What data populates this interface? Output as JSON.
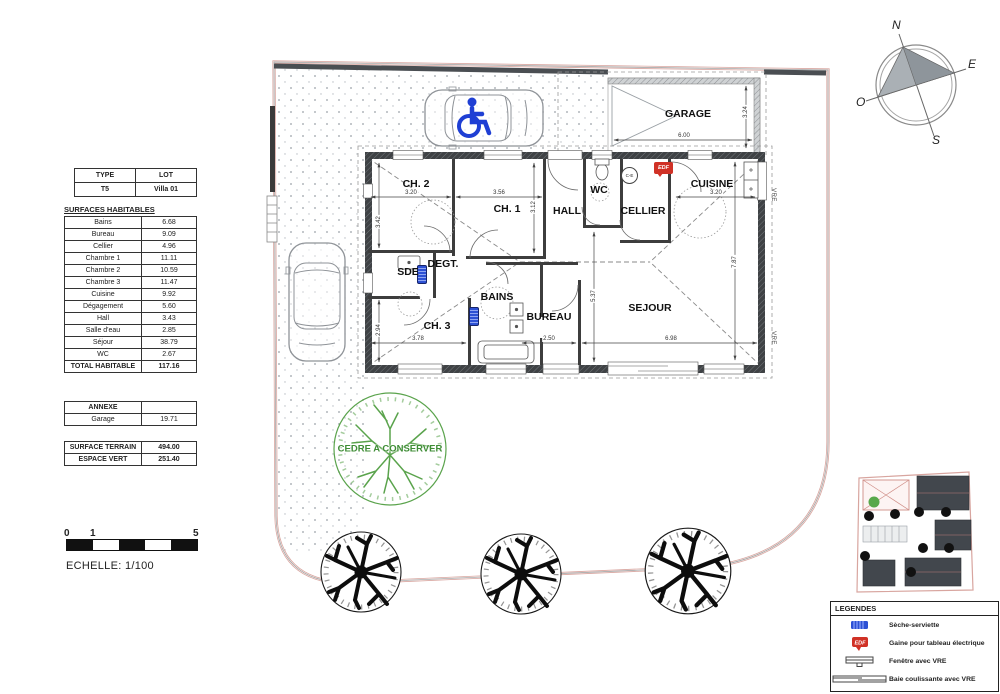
{
  "type_table": {
    "headers": [
      "TYPE",
      "LOT"
    ],
    "row": [
      "T5",
      "Villa 01"
    ]
  },
  "surfaces": {
    "title": "SURFACES HABITABLES",
    "rows": [
      [
        "Bains",
        "6.68"
      ],
      [
        "Bureau",
        "9.09"
      ],
      [
        "Cellier",
        "4.96"
      ],
      [
        "Chambre 1",
        "11.11"
      ],
      [
        "Chambre 2",
        "10.59"
      ],
      [
        "Chambre 3",
        "11.47"
      ],
      [
        "Cuisine",
        "9.92"
      ],
      [
        "Dégagement",
        "5.60"
      ],
      [
        "Hall",
        "3.43"
      ],
      [
        "Salle d'eau",
        "2.85"
      ],
      [
        "Séjour",
        "38.79"
      ],
      [
        "WC",
        "2.67"
      ]
    ],
    "total_label": "TOTAL HABITABLE",
    "total_value": "117.16"
  },
  "annexe": {
    "header": "ANNEXE",
    "rows": [
      [
        "Garage",
        "19.71"
      ]
    ]
  },
  "terrain": {
    "rows": [
      [
        "SURFACE TERRAIN",
        "494.00"
      ],
      [
        "ESPACE VERT",
        "251.40"
      ]
    ]
  },
  "scale": {
    "ticks": [
      "0",
      "1",
      "5"
    ],
    "caption": "ECHELLE: 1/100"
  },
  "compass": {
    "n": "N",
    "e": "E",
    "s": "S",
    "o": "O"
  },
  "plan": {
    "rooms": [
      {
        "name": "GARAGE",
        "x": 688,
        "y": 114
      },
      {
        "name": "CH. 2",
        "x": 416,
        "y": 184
      },
      {
        "name": "CH. 1",
        "x": 507,
        "y": 209
      },
      {
        "name": "HALL",
        "x": 567,
        "y": 211
      },
      {
        "name": "WC",
        "x": 599,
        "y": 190
      },
      {
        "name": "CELLIER",
        "x": 643,
        "y": 211
      },
      {
        "name": "CUISINE",
        "x": 712,
        "y": 184
      },
      {
        "name": "SDE",
        "x": 408,
        "y": 272
      },
      {
        "name": "DEGT.",
        "x": 443,
        "y": 264
      },
      {
        "name": "BAINS",
        "x": 497,
        "y": 297
      },
      {
        "name": "CH. 3",
        "x": 437,
        "y": 326
      },
      {
        "name": "BUREAU",
        "x": 549,
        "y": 317
      },
      {
        "name": "SEJOUR",
        "x": 650,
        "y": 308
      }
    ],
    "dimensions": [
      {
        "label": "3.20",
        "x": 411,
        "y": 193
      },
      {
        "label": "3.56",
        "x": 499,
        "y": 193
      },
      {
        "label": "3.42",
        "x": 379,
        "y": 222,
        "v": true
      },
      {
        "label": "3.12",
        "x": 534,
        "y": 207,
        "v": true
      },
      {
        "label": "3.78",
        "x": 418,
        "y": 339
      },
      {
        "label": "2.94",
        "x": 379,
        "y": 330,
        "v": true
      },
      {
        "label": "2.50",
        "x": 549,
        "y": 339
      },
      {
        "label": "6.98",
        "x": 671,
        "y": 339
      },
      {
        "label": "5.37",
        "x": 594,
        "y": 296,
        "v": true
      },
      {
        "label": "7.87",
        "x": 735,
        "y": 262,
        "v": true
      },
      {
        "label": "3.20",
        "x": 716,
        "y": 193
      },
      {
        "label": "6.00",
        "x": 684,
        "y": 136
      },
      {
        "label": "3.24",
        "x": 746,
        "y": 112,
        "v": true
      }
    ],
    "badges": {
      "edf": "EDF",
      "ce": "C-E",
      "vre": "VRE"
    },
    "tree_label": "CEDRE A CONSERVER"
  },
  "legend": {
    "title": "LEGENDES",
    "items": [
      {
        "icon": "towel-dryer-icon",
        "label": "Sèche-serviette"
      },
      {
        "icon": "edf-duct-icon",
        "label": "Gaine pour tableau électrique"
      },
      {
        "icon": "window-icon",
        "label": "Fenêtre avec VRE"
      },
      {
        "icon": "sliding-bay-icon",
        "label": "Baie coulissante avec VRE"
      }
    ]
  }
}
